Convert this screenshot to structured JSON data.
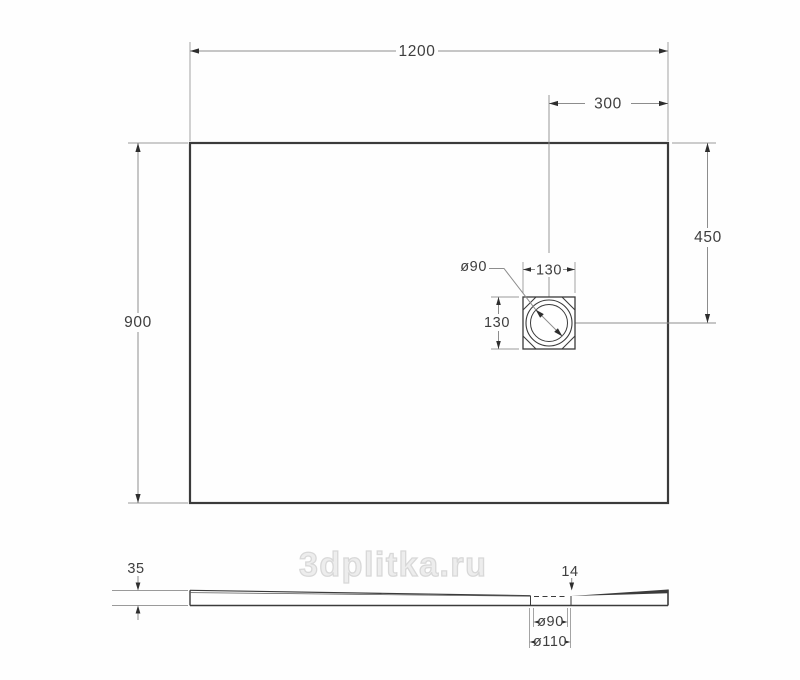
{
  "drawing": {
    "kind": "technical dimensional drawing, shower tray, top and side views",
    "units": "mm",
    "top_view": {
      "width": "1200",
      "depth": "900",
      "drain_from_right": "300",
      "drain_from_top": "450",
      "drain_box_width": "130",
      "drain_box_height": "130",
      "drain_diameter": "ø90"
    },
    "side_view": {
      "thickness": "35",
      "lip_height": "14",
      "hole_diameter": "ø90",
      "flange_diameter": "ø110"
    },
    "watermark": {
      "text": "3dplitka.ru"
    },
    "colors": {
      "outline": "#3b3b3b",
      "dimension_line": "#8d8d8d",
      "extension_line": "#9a9a9a",
      "arrow": "#2e2e2e",
      "text": "#3e3e3e",
      "watermark": "#d8d8d8",
      "background": "#fefefe"
    }
  }
}
